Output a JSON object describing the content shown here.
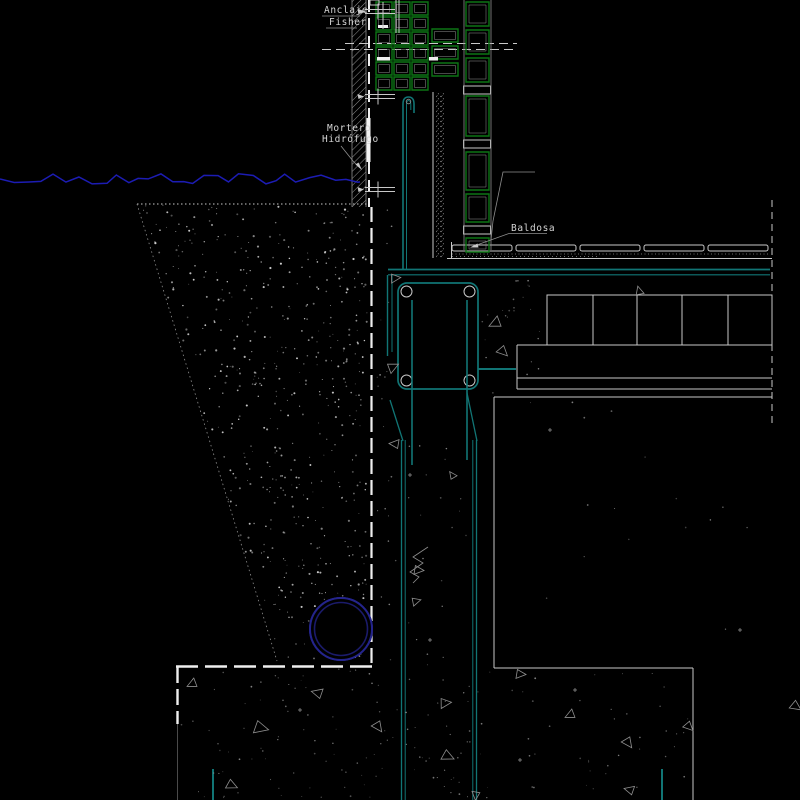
{
  "drawing": {
    "labels": {
      "anclaje": {
        "line1": "Anclaje",
        "line2": "Fisher"
      },
      "mortero": {
        "line1": "Mortero",
        "line2": "Hidrófugo"
      },
      "baldosa": {
        "text": "Baldosa"
      }
    },
    "colors": {
      "background": "#000000",
      "line-white": "#c8c8c8",
      "line-bright": "#efefef",
      "line-dim": "#8f8f8f",
      "green": "#0c7414",
      "green-bright": "#12a021",
      "teal": "#117575",
      "navy": "#1c1cb4",
      "circle-outer": "#24248c",
      "circle-inner": "#1b1b6b",
      "text": "#d4d4d4"
    }
  }
}
